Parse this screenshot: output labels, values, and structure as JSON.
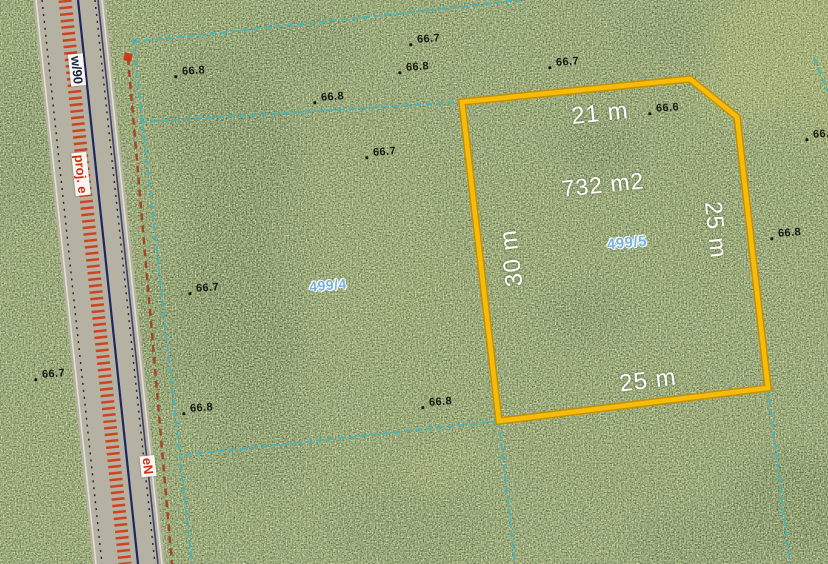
{
  "app": {
    "view": "aerial-cadastral-parcel-map"
  },
  "parcel": {
    "selected": {
      "id": "499/5",
      "area": "732 m2",
      "dim_top": "21 m",
      "dim_right": "25 m",
      "dim_bottom": "25 m",
      "dim_left": "30 m"
    },
    "adjacent_id": "499/4"
  },
  "road": {
    "labels": {
      "designation": "w/90",
      "project": "proj. e",
      "utility": "eN"
    }
  },
  "elevations": [
    {
      "v": "66.7",
      "x": 417,
      "y": 33
    },
    {
      "v": "66.8",
      "x": 406,
      "y": 61
    },
    {
      "v": "66.8",
      "x": 182,
      "y": 65
    },
    {
      "v": "66.8",
      "x": 321,
      "y": 91
    },
    {
      "v": "66.7",
      "x": 373,
      "y": 146
    },
    {
      "v": "66.7",
      "x": 556,
      "y": 56
    },
    {
      "v": "66.6",
      "x": 656,
      "y": 102
    },
    {
      "v": "66.8",
      "x": 813,
      "y": 128
    },
    {
      "v": "66.8",
      "x": 778,
      "y": 227
    },
    {
      "v": "66.7",
      "x": 196,
      "y": 282
    },
    {
      "v": "66.7",
      "x": 42,
      "y": 368
    },
    {
      "v": "66.8",
      "x": 190,
      "y": 402
    },
    {
      "v": "66.8",
      "x": 429,
      "y": 396
    }
  ],
  "colors": {
    "parcel_outline": "#f5bc0c",
    "boundary_teal": "#3fb5c2",
    "parcel_id_blue": "#79b1dd",
    "elevation_text": "#161613",
    "road_hatch_red": "#d13a16",
    "road_navy": "#1e2660",
    "utility_red_brown": "#a34526",
    "label_white": "#ffffff",
    "road_surface": "#b6b2a3"
  }
}
